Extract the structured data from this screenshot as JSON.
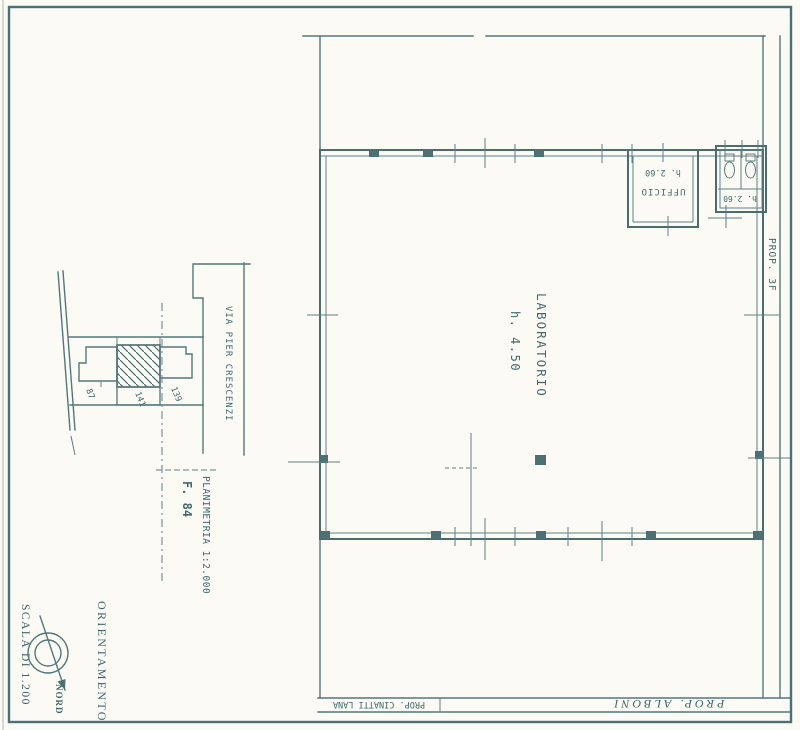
{
  "page": {
    "ink_color": "#537779",
    "paper_color": "#fbfaf5"
  },
  "site_plan": {
    "street_label": "VIA PIER CRESCENZI",
    "parcel_labels": [
      "87",
      "141",
      "139"
    ],
    "planimetria_label": "PLANIMETRIA 1:2.000",
    "sheet_label": "F. 84"
  },
  "main_plan": {
    "room_label": "LABORATORIO",
    "room_height": "h. 4.50",
    "office_label": "UFFICIO",
    "office_height": "h. 2.60",
    "wc_height": "h. 2.60",
    "right_boundary_label": "PROP. 3F"
  },
  "title_block": {
    "left_owner": "PROP. CINATTI LANA",
    "right_owner": "PROP. ALBONI"
  },
  "legend": {
    "scale_label": "SCALA DI 1.200",
    "orientation_label": "ORIENTAMENTO",
    "north_label": "NORD"
  }
}
